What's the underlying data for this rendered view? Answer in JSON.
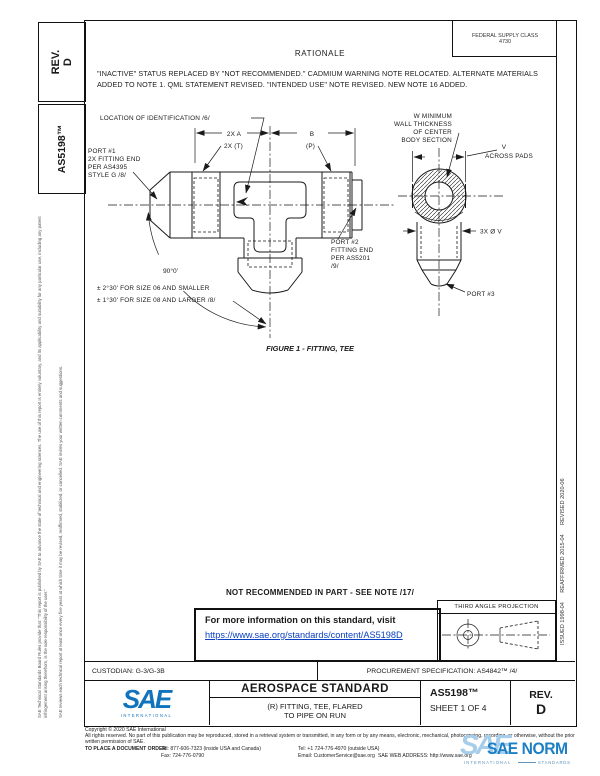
{
  "sidebar": {
    "rev_label": "REV.",
    "rev_value": "D",
    "doc_number": "AS5198™",
    "disclaimer1": "SAE Technical Standards Board Rules provide that: “This report is published by SAE to advance the state of technical and engineering sciences. The use of this report is entirely voluntary, and its applicability and suitability for any particular use, including any patent infringement arising therefrom, is the sole responsibility of the user.”",
    "disclaimer2": "SAE reviews each technical report at least once every five years at which time it may be revised, reaffirmed, stabilized, or cancelled. SAE invites your written comments and suggestions."
  },
  "header": {
    "fsc_label": "FEDERAL SUPPLY CLASS",
    "fsc_value": "4730",
    "rationale_title": "RATIONALE",
    "rationale_text": "\"INACTIVE\" STATUS REPLACED BY \"NOT RECOMMENDED.\" CADMIUM WARNING NOTE RELOCATED. ALTERNATE MATERIALS ADDED TO NOTE 1. QML STATEMENT REVISED. \"INTENDED USE\" NOTE REVISED. NEW NOTE 16 ADDED."
  },
  "revision_history": "ISSUED 1998-04      REAFFIRMED 2015-04      REVISED 2020-06",
  "figure": {
    "caption": "FIGURE 1 - FITTING, TEE",
    "location_id": "LOCATION OF IDENTIFICATION /6/",
    "dim_2xa": "2X A",
    "dim_b": "B",
    "dim_2xt": "2X (T)",
    "dim_p": "(P)",
    "port1_line1": "PORT #1",
    "port1_line2": "2X FITTING END",
    "port1_line3": "PER AS4395",
    "port1_line4": "STYLE G /8/",
    "port2_line1": "PORT #2",
    "port2_line2": "FITTING END",
    "port2_line3": "PER AS5201",
    "port2_line4": "/9/",
    "port3": "PORT #3",
    "wall_line1": "W MINIMUM",
    "wall_line2": "WALL THICKNESS",
    "wall_line3": "OF CENTER",
    "wall_line4": "BODY SECTION",
    "v_label": "V",
    "across_pads": "ACROSS PADS",
    "dia_v": "3X Ø V",
    "angle": "90°0'",
    "angle_tol1": "± 2°30' FOR SIZE 06 AND SMALLER",
    "angle_tol2": "± 1°30' FOR SIZE 08 AND LARGER /8/"
  },
  "notice": {
    "not_recommended": "NOT RECOMMENDED IN PART - SEE NOTE /17/",
    "info_text": "For more information on this standard, visit",
    "info_link": "https://www.sae.org/standards/content/AS5198D"
  },
  "projection_title": "THIRD ANGLE PROJECTION",
  "title_block": {
    "custodian": "CUSTODIAN: G-3/G-3B",
    "procurement": "PROCUREMENT SPECIFICATION: AS4842™ /4/",
    "logo_text": "SAE",
    "logo_sub": "INTERNATIONAL",
    "standard_type": "AEROSPACE STANDARD",
    "title_line1": "(R) FITTING, TEE, FLARED",
    "title_line2": "TO PIPE ON RUN",
    "doc_number": "AS5198™",
    "sheet": "SHEET 1 OF 4",
    "rev_label": "REV.",
    "rev_value": "D"
  },
  "footer": {
    "copyright": "Copyright © 2020 SAE International",
    "rights": "All rights reserved. No part of this publication may be reproduced, stored in a retrieval system or transmitted, in any form or by any means, electronic, mechanical, photocopying, recording, or otherwise, without the prior written permission of SAE.",
    "order_label": "TO PLACE A DOCUMENT ORDER:",
    "tel_inside": "Tel: 877-606-7323 (inside USA and Canada)",
    "tel_outside": "Tel: +1 724-776-4970 (outside USA)",
    "fax": "Fax: 724-776-0790",
    "email": "Email: CustomerService@sae.org",
    "web": "SAE WEB ADDRESS: http://www.sae.org"
  },
  "watermark": {
    "logo": "SAE",
    "title": "SAE NORM",
    "subtitle": "INTERNATIONAL",
    "tagline": "STANDARDS"
  },
  "colors": {
    "link": "#0a40c2",
    "sae_blue": "#1173BB",
    "watermark_blue": "#1d80c4",
    "line": "#1a1a1a"
  }
}
